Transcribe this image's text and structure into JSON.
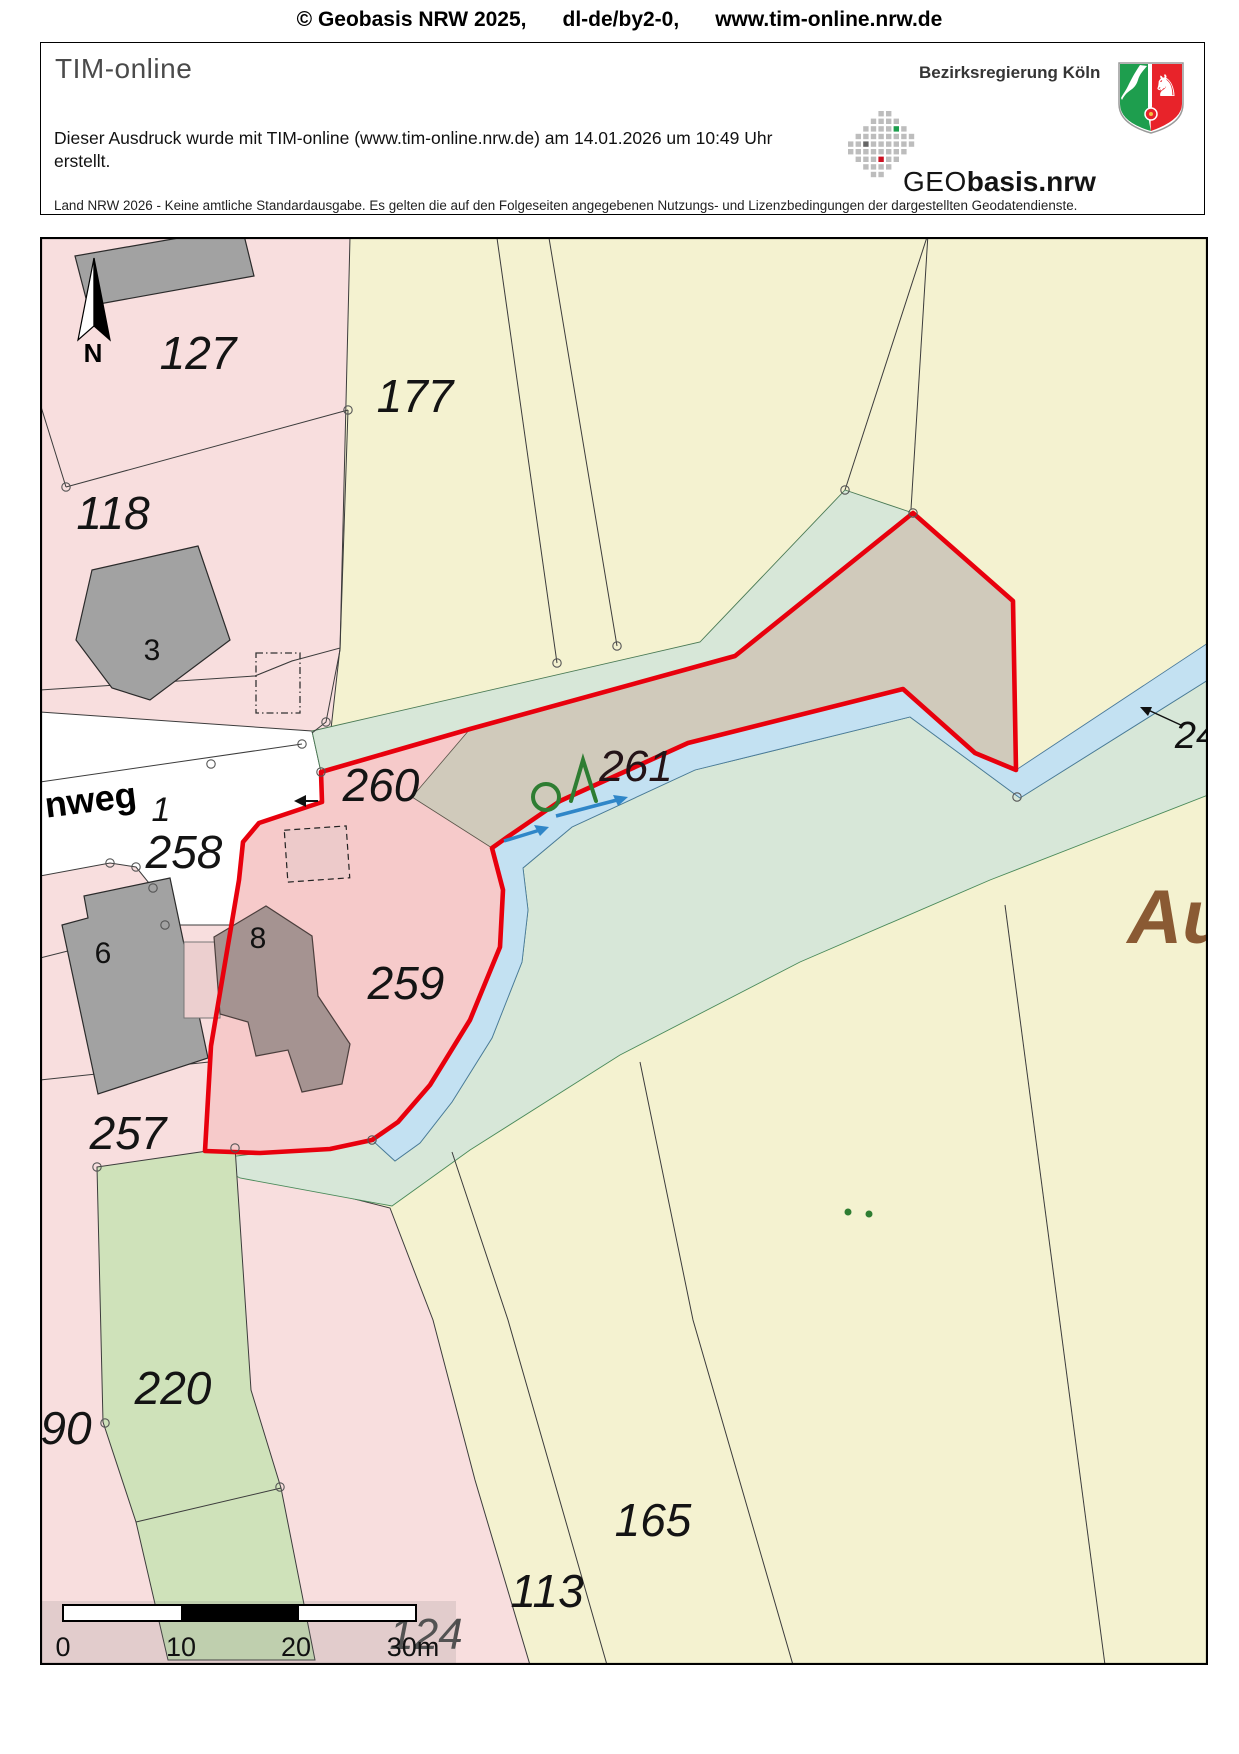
{
  "page_header": {
    "copyright": "© Geobasis NRW 2025,",
    "license": "dl-de/by2-0,",
    "website": "www.tim-online.nrw.de"
  },
  "print_header": {
    "app_title": "TIM-online",
    "authority": "Bezirksregierung Köln",
    "logo_geo": "GEO",
    "logo_basis": "basis.nrw",
    "created_text": "Dieser Ausdruck wurde mit TIM-online (www.tim-online.nrw.de) am 14.01.2026 um 10:49 Uhr erstellt.",
    "disclaimer": "Land NRW 2026 - Keine amtliche Standardausgabe. Es gelten die auf den Folgeseiten angegebenen Nutzungs- und Lizenzbedingungen der dargestellten Geodatendienste."
  },
  "map": {
    "north_label": "N",
    "labels": [
      {
        "t": "127",
        "x": 198,
        "y": 369,
        "c": "lbl-parcel"
      },
      {
        "t": "118",
        "x": 113,
        "y": 529,
        "c": "lbl-parcel"
      },
      {
        "t": "177",
        "x": 415,
        "y": 412,
        "c": "lbl-parcel"
      },
      {
        "t": "258",
        "x": 184,
        "y": 868,
        "c": "lbl-parcel"
      },
      {
        "t": "260",
        "x": 381,
        "y": 801,
        "c": "lbl-parcel"
      },
      {
        "t": "261",
        "x": 636,
        "y": 781,
        "c": "lbl-parcel-dark"
      },
      {
        "t": "259",
        "x": 406,
        "y": 999,
        "c": "lbl-parcel"
      },
      {
        "t": "257",
        "x": 128,
        "y": 1149,
        "c": "lbl-parcel"
      },
      {
        "t": "220",
        "x": 173,
        "y": 1404,
        "c": "lbl-parcel"
      },
      {
        "t": "90",
        "x": 66,
        "y": 1444,
        "c": "lbl-parcel"
      },
      {
        "t": "165",
        "x": 653,
        "y": 1536,
        "c": "lbl-parcel"
      },
      {
        "t": "113",
        "x": 547,
        "y": 1607,
        "c": "lbl-parcel"
      },
      {
        "t": "124",
        "x": 426,
        "y": 1649,
        "c": "lbl-parcel-gray"
      },
      {
        "t": "1",
        "x": 161,
        "y": 821,
        "c": "lbl-housenr-it"
      },
      {
        "t": "24",
        "x": 1196,
        "y": 748,
        "c": "lbl-parcel-sm"
      },
      {
        "t": "3",
        "x": 152,
        "y": 660,
        "c": "lbl-housenr"
      },
      {
        "t": "6",
        "x": 103,
        "y": 963,
        "c": "lbl-housenr"
      },
      {
        "t": "8",
        "x": 258,
        "y": 948,
        "c": "lbl-housenr"
      },
      {
        "t": "nweg",
        "x": 92,
        "y": 812,
        "c": "lbl-street",
        "r": -7
      },
      {
        "t": "Au",
        "x": 1178,
        "y": 943,
        "c": "lbl-placename"
      },
      {
        "t": "N",
        "x": 93,
        "y": 362,
        "c": "lbl-north"
      }
    ],
    "scalebar": {
      "ticks": [
        "0",
        "10",
        "20",
        "30m"
      ]
    },
    "colors": {
      "selection_red": "#e8000d",
      "parcel_pink": "#f8dede",
      "selected_pink": "#f6caca",
      "parcel_yellow": "#f4f2d0",
      "greenland": "#d7e7d8",
      "meadow_green": "#cfe2ba",
      "water_blue": "#c3e1f2",
      "farmland_taupe": "#d0cabb",
      "building_gray": "#a2a2a2",
      "building_dark": "#a59391",
      "vegetation_green": "#2e7d32",
      "placename_brown": "#8a5a33"
    }
  }
}
